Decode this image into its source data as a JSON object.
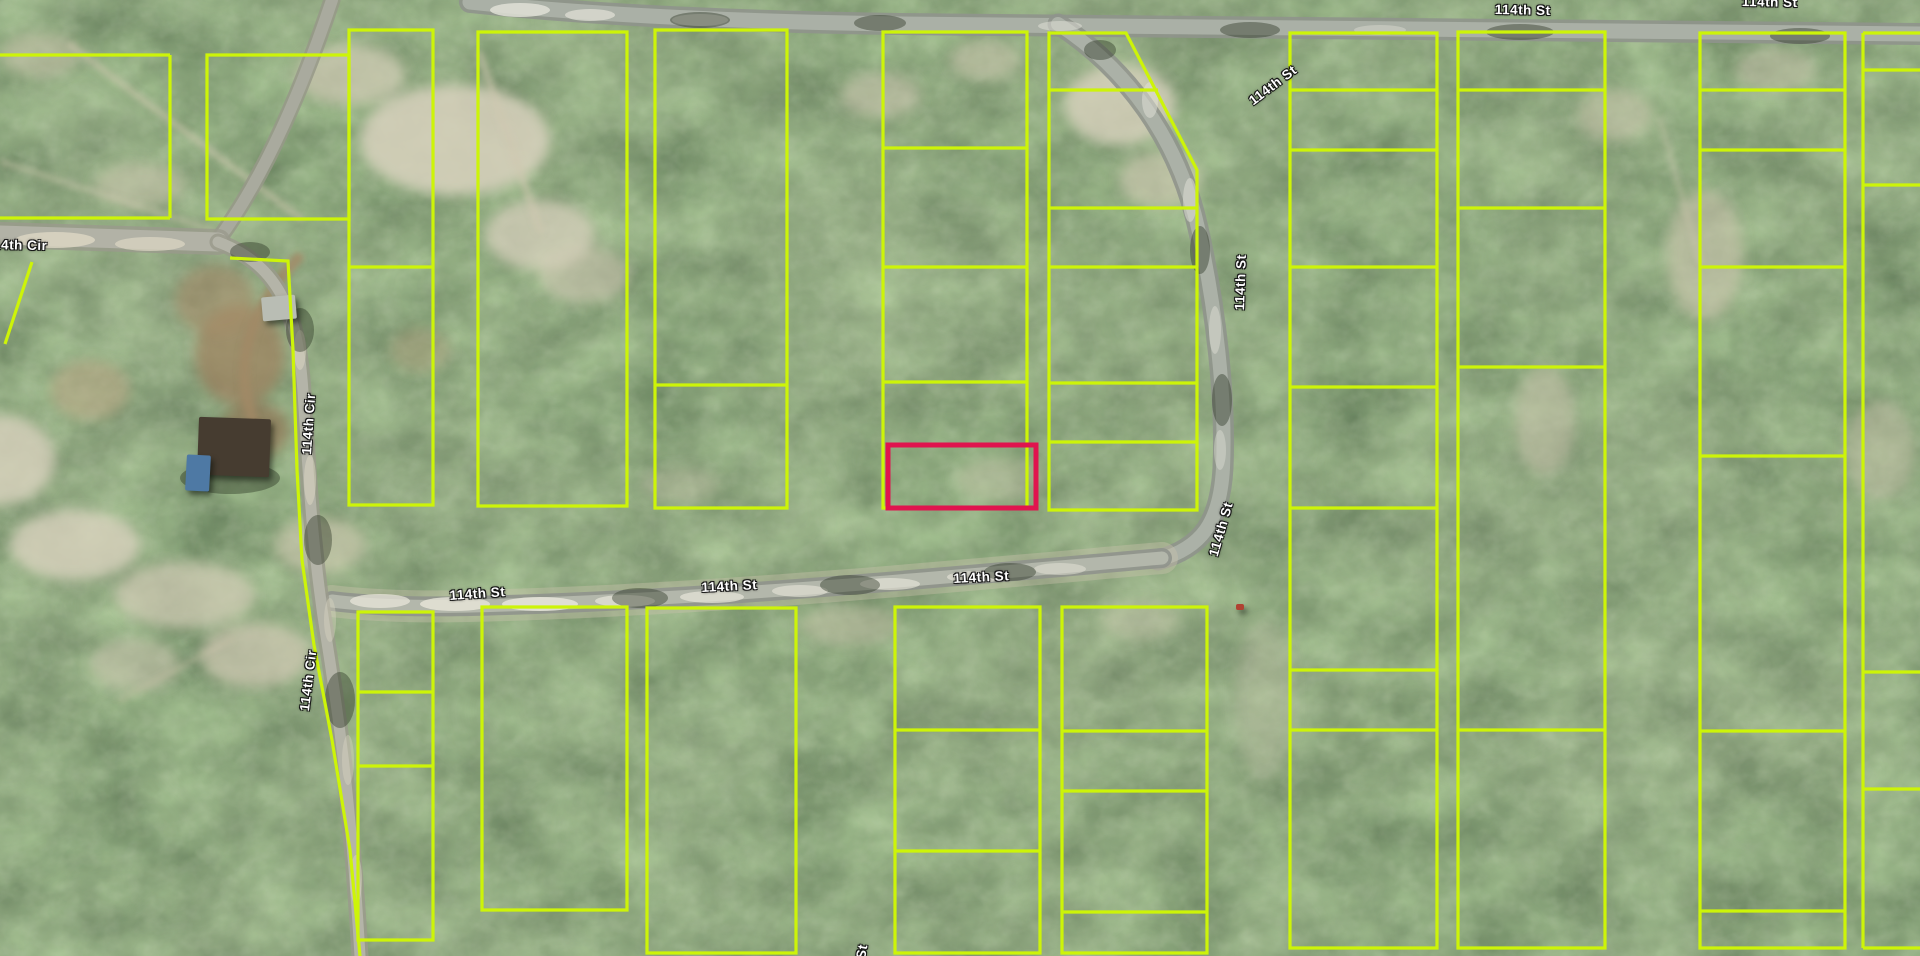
{
  "canvas": {
    "width": 1920,
    "height": 956
  },
  "colors": {
    "parcel_line": "#cdf408",
    "highlight_line": "#e0144e",
    "label_text": "#ffffff",
    "label_halo": "#151515",
    "paved_road": "#aab0a6",
    "dirt_road": "#b4b4a8",
    "forest_base": "#3c4a33"
  },
  "map": {
    "type": "aerial-parcel-map",
    "street_labels": [
      {
        "text": "114th St",
        "x": 1495,
        "y": 2,
        "rot": 1
      },
      {
        "text": "114th St",
        "x": 1742,
        "y": -6,
        "rot": 1
      },
      {
        "text": "114th St",
        "x": 1246,
        "y": 96,
        "rot": -37
      },
      {
        "text": "114th St",
        "x": 1232,
        "y": 310,
        "rot": -88
      },
      {
        "text": "114th St",
        "x": 1206,
        "y": 554,
        "rot": -74
      },
      {
        "text": "114th St",
        "x": 449,
        "y": 588,
        "rot": -4
      },
      {
        "text": "114th St",
        "x": 701,
        "y": 580,
        "rot": -3
      },
      {
        "text": "114th St",
        "x": 953,
        "y": 571,
        "rot": -3
      },
      {
        "text": "114th Cir",
        "x": -14,
        "y": 237,
        "rot": 1
      },
      {
        "text": "114th Cir",
        "x": 299,
        "y": 454,
        "rot": -86
      },
      {
        "text": "114th Cir",
        "x": 297,
        "y": 710,
        "rot": -83
      },
      {
        "text": "114th St",
        "x": 846,
        "y": 998,
        "rot": -80
      }
    ],
    "highlight_parcel": {
      "x": 888,
      "y": 445,
      "w": 148,
      "h": 63
    },
    "parcels": [
      {
        "id": "nw-1",
        "x": 0,
        "y": 55,
        "w": 170,
        "h": 163,
        "sides": "trb"
      },
      {
        "id": "nw-2",
        "x": 207,
        "y": 55,
        "w": 142,
        "h": 164
      },
      {
        "id": "nw-3",
        "x": 349,
        "y": 30,
        "w": 84,
        "h": 475,
        "dividers": [
          {
            "y": 267
          }
        ]
      },
      {
        "id": "nw-4",
        "x": 478,
        "y": 32,
        "w": 149,
        "h": 474
      },
      {
        "id": "nw-5",
        "x": 655,
        "y": 30,
        "w": 132,
        "h": 478,
        "dividers": [
          {
            "y": 385
          }
        ]
      },
      {
        "id": "nw-6",
        "x": 883,
        "y": 32,
        "w": 144,
        "h": 476,
        "dividers": [
          {
            "y": 148
          },
          {
            "y": 267
          },
          {
            "y": 382
          }
        ]
      },
      {
        "id": "nw-7",
        "poly": [
          [
            1049,
            33
          ],
          [
            1126,
            33
          ],
          [
            1197,
            170
          ],
          [
            1197,
            510
          ],
          [
            1049,
            510
          ]
        ],
        "dividers": [
          {
            "y": 90,
            "x1": 1049,
            "x2": 1158
          },
          {
            "y": 208,
            "x1": 1049,
            "x2": 1197
          },
          {
            "y": 267,
            "x1": 1049,
            "x2": 1197
          },
          {
            "y": 383,
            "x1": 1049,
            "x2": 1197
          },
          {
            "y": 442,
            "x1": 1049,
            "x2": 1197
          }
        ]
      },
      {
        "id": "e-1",
        "x": 1290,
        "y": 33,
        "w": 147,
        "h": 915,
        "dividers": [
          {
            "y": 90
          },
          {
            "y": 150
          },
          {
            "y": 267
          },
          {
            "y": 387
          },
          {
            "y": 508
          },
          {
            "y": 670
          },
          {
            "y": 730
          }
        ]
      },
      {
        "id": "e-2",
        "x": 1458,
        "y": 32,
        "w": 147,
        "h": 916,
        "dividers": [
          {
            "y": 90
          },
          {
            "y": 208
          },
          {
            "y": 367
          },
          {
            "y": 730
          }
        ]
      },
      {
        "id": "e-3",
        "x": 1700,
        "y": 33,
        "w": 145,
        "h": 915,
        "dividers": [
          {
            "y": 90
          },
          {
            "y": 150
          },
          {
            "y": 267
          },
          {
            "y": 456
          },
          {
            "y": 731
          },
          {
            "y": 911
          }
        ]
      },
      {
        "id": "e-4",
        "x": 1863,
        "y": 33,
        "w": 90,
        "h": 915,
        "sides": "tbl",
        "dividers": [
          {
            "y": 70
          },
          {
            "y": 185
          },
          {
            "y": 672
          },
          {
            "y": 789
          }
        ]
      },
      {
        "id": "s-1",
        "x": 358,
        "y": 612,
        "w": 75,
        "h": 328,
        "dividers": [
          {
            "y": 692
          },
          {
            "y": 766
          }
        ]
      },
      {
        "id": "s-2",
        "x": 482,
        "y": 607,
        "w": 145,
        "h": 303
      },
      {
        "id": "s-3",
        "x": 647,
        "y": 608,
        "w": 149,
        "h": 345
      },
      {
        "id": "s-4",
        "x": 895,
        "y": 607,
        "w": 145,
        "h": 346,
        "dividers": [
          {
            "y": 730
          },
          {
            "y": 851
          }
        ]
      },
      {
        "id": "s-5",
        "x": 1062,
        "y": 607,
        "w": 145,
        "h": 346,
        "dividers": [
          {
            "y": 731
          },
          {
            "y": 791
          },
          {
            "y": 912
          }
        ]
      },
      {
        "id": "cir-road-line",
        "polyline": [
          [
            230,
            258
          ],
          [
            288,
            261
          ],
          [
            293,
            350
          ],
          [
            297,
            470
          ],
          [
            302,
            560
          ],
          [
            314,
            645
          ],
          [
            332,
            740
          ],
          [
            350,
            850
          ],
          [
            360,
            956
          ]
        ]
      },
      {
        "id": "west-diagonal-line",
        "polyline": [
          [
            32,
            262
          ],
          [
            5,
            344
          ]
        ]
      }
    ],
    "structures": [
      {
        "kind": "house-roof",
        "x": 198,
        "y": 418,
        "w": 72,
        "h": 58,
        "rot": 2,
        "color": "#463c30"
      },
      {
        "kind": "shed-roof",
        "x": 262,
        "y": 296,
        "w": 34,
        "h": 24,
        "rot": -5,
        "color": "#b9bdb4"
      },
      {
        "kind": "blue-tarp",
        "x": 186,
        "y": 455,
        "w": 24,
        "h": 36,
        "rot": 3,
        "color": "#4e79a4"
      },
      {
        "kind": "vehicle",
        "x": 1236,
        "y": 604,
        "w": 8,
        "h": 6,
        "rot": 0,
        "color": "#b04232"
      }
    ]
  }
}
